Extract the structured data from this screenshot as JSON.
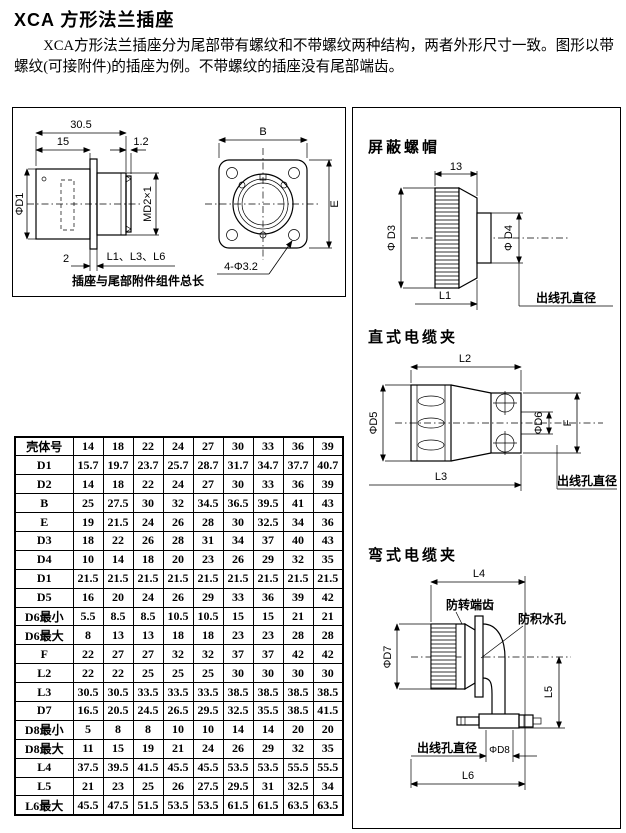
{
  "page": {
    "title": "XCA 方形法兰插座",
    "paragraph": "XCA方形法兰插座分为尾部带有螺纹和不带螺纹两种结构，两者外形尺寸一致。图形以带螺纹(可接附件)的插座为例。不带螺纹的插座没有尾部端齿。"
  },
  "left_drawing": {
    "dim_30_5": "30.5",
    "dim_15": "15",
    "dim_1_2": "1.2",
    "phi_d1": "ΦD1",
    "md2x1": "MD2×1",
    "dim_2": "2",
    "l1_l3_l6": "L1、L3、L6",
    "caption": "插座与尾部附件组件总长",
    "dim_b": "B",
    "dim_e": "E",
    "holes": "4-Φ3.2"
  },
  "shield_nut": {
    "heading": "屏蔽螺帽",
    "dim_13": "13",
    "phi_d3": "Φ D3",
    "phi_d4": "Φ D4",
    "l1": "L1",
    "outlet": "出线孔直径"
  },
  "straight_clamp": {
    "heading": "直式电缆夹",
    "l2": "L2",
    "phi_d5": "ΦD5",
    "phi_d6": "ΦD6",
    "f": "F",
    "l3": "L3",
    "outlet": "出线孔直径"
  },
  "bent_clamp": {
    "heading": "弯式电缆夹",
    "l4": "L4",
    "teeth": "防转端齿",
    "drain": "防积水孔",
    "phi_d7": "ΦD7",
    "l5": "L5",
    "outlet": "出线孔直径",
    "phi_d8": "ΦD8",
    "l6": "L6"
  },
  "table": {
    "header": [
      "壳体号",
      "14",
      "18",
      "22",
      "24",
      "27",
      "30",
      "33",
      "36",
      "39"
    ],
    "rows": [
      {
        "label": "D1",
        "values": [
          "15.7",
          "19.7",
          "23.7",
          "25.7",
          "28.7",
          "31.7",
          "34.7",
          "37.7",
          "40.7"
        ]
      },
      {
        "label": "D2",
        "values": [
          "14",
          "18",
          "22",
          "24",
          "27",
          "30",
          "33",
          "36",
          "39"
        ]
      },
      {
        "label": "B",
        "values": [
          "25",
          "27.5",
          "30",
          "32",
          "34.5",
          "36.5",
          "39.5",
          "41",
          "43"
        ]
      },
      {
        "label": "E",
        "values": [
          "19",
          "21.5",
          "24",
          "26",
          "28",
          "30",
          "32.5",
          "34",
          "36"
        ]
      },
      {
        "label": "D3",
        "values": [
          "18",
          "22",
          "26",
          "28",
          "31",
          "34",
          "37",
          "40",
          "43"
        ]
      },
      {
        "label": "D4",
        "values": [
          "10",
          "14",
          "18",
          "20",
          "23",
          "26",
          "29",
          "32",
          "35"
        ]
      },
      {
        "label": "D1",
        "values": [
          "21.5",
          "21.5",
          "21.5",
          "21.5",
          "21.5",
          "21.5",
          "21.5",
          "21.5",
          "21.5"
        ]
      },
      {
        "label": "D5",
        "values": [
          "16",
          "20",
          "24",
          "26",
          "29",
          "33",
          "36",
          "39",
          "42"
        ]
      },
      {
        "label": "D6最小",
        "values": [
          "5.5",
          "8.5",
          "8.5",
          "10.5",
          "10.5",
          "15",
          "15",
          "21",
          "21"
        ]
      },
      {
        "label": "D6最大",
        "values": [
          "8",
          "13",
          "13",
          "18",
          "18",
          "23",
          "23",
          "28",
          "28"
        ]
      },
      {
        "label": "F",
        "values": [
          "22",
          "27",
          "27",
          "32",
          "32",
          "37",
          "37",
          "42",
          "42"
        ]
      },
      {
        "label": "L2",
        "values": [
          "22",
          "22",
          "25",
          "25",
          "25",
          "30",
          "30",
          "30",
          "30"
        ]
      },
      {
        "label": "L3",
        "values": [
          "30.5",
          "30.5",
          "33.5",
          "33.5",
          "33.5",
          "38.5",
          "38.5",
          "38.5",
          "38.5"
        ]
      },
      {
        "label": "D7",
        "values": [
          "16.5",
          "20.5",
          "24.5",
          "26.5",
          "29.5",
          "32.5",
          "35.5",
          "38.5",
          "41.5"
        ]
      },
      {
        "label": "D8最小",
        "values": [
          "5",
          "8",
          "8",
          "10",
          "10",
          "14",
          "14",
          "20",
          "20"
        ]
      },
      {
        "label": "D8最大",
        "values": [
          "11",
          "15",
          "19",
          "21",
          "24",
          "26",
          "29",
          "32",
          "35"
        ]
      },
      {
        "label": "L4",
        "values": [
          "37.5",
          "39.5",
          "41.5",
          "45.5",
          "45.5",
          "53.5",
          "53.5",
          "55.5",
          "55.5"
        ]
      },
      {
        "label": "L5",
        "values": [
          "21",
          "23",
          "25",
          "26",
          "27.5",
          "29.5",
          "31",
          "32.5",
          "34"
        ]
      },
      {
        "label": "L6最大",
        "values": [
          "45.5",
          "47.5",
          "51.5",
          "53.5",
          "53.5",
          "61.5",
          "61.5",
          "63.5",
          "63.5"
        ]
      }
    ]
  }
}
